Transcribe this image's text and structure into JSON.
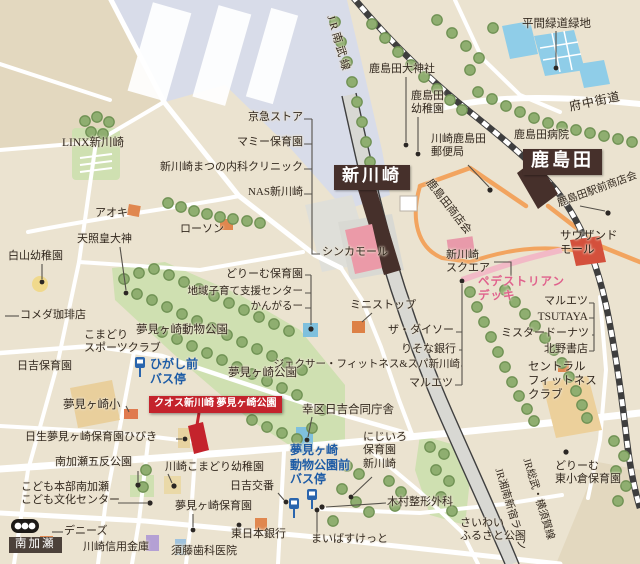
{
  "map": {
    "colors": {
      "background": "#ebe3d0",
      "park_green": "#cfe0b1",
      "tree_green": "#8fae70",
      "rail_yard": "#d8dce9",
      "water": "#8fcde8",
      "station_box": "#46302b",
      "property_red": "#c4232c",
      "deck_pink": "#f2b9c6",
      "road_orange": "#f2a45f",
      "bus_blue": "#2a65ad",
      "label_text": "#33291f"
    },
    "icons": [
      {
        "name": "bus-stop-icon",
        "meaning": "bus stop pole sign"
      },
      {
        "name": "crossing-roundel-icon",
        "meaning": "Minamikase crossing marker"
      },
      {
        "name": "property-marker-icon",
        "meaning": "advertised property location"
      }
    ],
    "stations": [
      "新川崎",
      "鹿島田"
    ],
    "property_flag": "クオス新川崎 夢見ヶ崎公園",
    "labels": [
      {
        "id": "jr-nambu-line-label",
        "t": "JR南武線",
        "x": 336,
        "y": 14,
        "rot": 74,
        "ls": 3,
        "s": 11
      },
      {
        "id": "hirama-ryokudo-ryokuchi",
        "t": "平間緑道緑地",
        "x": 522,
        "y": 17,
        "s": 11.5
      },
      {
        "id": "kashimada-daijinja",
        "t": "鹿島田大神社",
        "x": 369,
        "y": 63
      },
      {
        "id": "kashimada-yochien",
        "t": "鹿島田\n幼稚園",
        "x": 411,
        "y": 90
      },
      {
        "id": "fuchu-kaido",
        "t": "府中街道",
        "x": 568,
        "y": 100,
        "rot": -12,
        "s": 12,
        "ls": 1
      },
      {
        "id": "kashimada-byoin",
        "t": "鹿島田病院",
        "x": 514,
        "y": 129
      },
      {
        "id": "kawasaki-kashimada-yubinkyoku",
        "t": "川崎鹿島田\n郵便局",
        "x": 431,
        "y": 133
      },
      {
        "id": "shinkawasaki-station",
        "t": "新川崎",
        "x": 334,
        "y": 165,
        "s": 17,
        "cls": "box-sta"
      },
      {
        "id": "kashimada-station",
        "t": "鹿島田",
        "x": 523,
        "y": 149,
        "s": 18,
        "cls": "box-sta"
      },
      {
        "id": "kashimada-ekimae-shotenkai",
        "t": "鹿島田駅前商店会",
        "x": 556,
        "y": 199,
        "rot": -20,
        "s": 10.5
      },
      {
        "id": "kashimada-shotenkai",
        "t": "鹿島田商店会",
        "x": 433,
        "y": 177,
        "rot": 52,
        "s": 11
      },
      {
        "id": "keikyu-store",
        "t": "京急ストア",
        "x": 303,
        "y": 111,
        "al": "r"
      },
      {
        "id": "mammy-hoikuen",
        "t": "マミー保育園",
        "x": 303,
        "y": 136,
        "al": "r"
      },
      {
        "id": "shinkawasaki-matsuno-naika-clinic",
        "t": "新川崎まつの内科クリニック",
        "x": 303,
        "y": 161,
        "al": "r"
      },
      {
        "id": "nas-shinkawasaki",
        "t": "NAS新川崎",
        "x": 303,
        "y": 186,
        "al": "r"
      },
      {
        "id": "linx-shinkawasaki",
        "t": "LINX新川崎",
        "x": 62,
        "y": 136,
        "s": 11.5
      },
      {
        "id": "aoki",
        "t": "アオキ",
        "x": 95,
        "y": 207
      },
      {
        "id": "lawson",
        "t": "ローソン",
        "x": 180,
        "y": 223
      },
      {
        "id": "tensho-kotaijin",
        "t": "天照皇大神",
        "x": 77,
        "y": 233
      },
      {
        "id": "hakusan-yochien",
        "t": "白山幼稚園",
        "x": 8,
        "y": 250
      },
      {
        "id": "dream-hoikuen",
        "t": "どりーむ保育園",
        "x": 303,
        "y": 268,
        "al": "r"
      },
      {
        "id": "chiiki-kosodate-shien-center",
        "t": "地域子育て支援センター",
        "x": 303,
        "y": 286,
        "al": "r",
        "s": 10.5
      },
      {
        "id": "kangaroo",
        "t": "かんがるー",
        "x": 303,
        "y": 301,
        "al": "r",
        "s": 10.5
      },
      {
        "id": "komeda-coffee",
        "t": "コメダ珈琲店",
        "x": 20,
        "y": 309
      },
      {
        "id": "komadori-sports-club",
        "t": "こまどり\nスポーツクラブ",
        "x": 84,
        "y": 329
      },
      {
        "id": "yumemigasaki-dobutsu-koen",
        "t": "夢見ヶ崎動物公園",
        "x": 136,
        "y": 323,
        "s": 11.5
      },
      {
        "id": "hiyoshi-hoikuen",
        "t": "日吉保育園",
        "x": 17,
        "y": 360
      },
      {
        "id": "higashimae-bus-stop",
        "t": "ひがし前\nバス停",
        "x": 150,
        "y": 357,
        "s": 12,
        "cls": "c-blue"
      },
      {
        "id": "yumemigasaki-koen",
        "t": "夢見ヶ崎公園",
        "x": 228,
        "y": 366,
        "s": 11.5
      },
      {
        "id": "jexer-fitness-spa",
        "t": "ジェクサー・フィットネス&スパ新川崎",
        "x": 460,
        "y": 359,
        "al": "r",
        "s": 10.5
      },
      {
        "id": "ministop",
        "t": "ミニストップ",
        "x": 350,
        "y": 299
      },
      {
        "id": "the-daiso",
        "t": "ザ・ダイソー",
        "x": 454,
        "y": 324,
        "al": "r"
      },
      {
        "id": "risona-bank",
        "t": "りそな銀行",
        "x": 456,
        "y": 343,
        "al": "r"
      },
      {
        "id": "maruetsu-west",
        "t": "マルエツ",
        "x": 453,
        "y": 377,
        "al": "r"
      },
      {
        "id": "saiwai-ku-hiyoshi-godo-chosha",
        "t": "幸区日吉合同庁舎",
        "x": 302,
        "y": 403,
        "s": 11.5
      },
      {
        "id": "shinka-mall",
        "t": "シンカモール",
        "x": 322,
        "y": 246
      },
      {
        "id": "shinkawasaki-square",
        "t": "新川崎\nスクエア",
        "x": 446,
        "y": 249
      },
      {
        "id": "pedestrian-deck",
        "t": "ペデストリアン\nデッキ",
        "x": 478,
        "y": 275,
        "cls": "c-pink",
        "s": 11.5
      },
      {
        "id": "thousand-mall",
        "t": "サウザンド\nモール",
        "x": 560,
        "y": 229,
        "s": 11.5
      },
      {
        "id": "maruetsu-east",
        "t": "マルエツ",
        "x": 588,
        "y": 295,
        "al": "r"
      },
      {
        "id": "tsutaya",
        "t": "TSUTAYA",
        "x": 588,
        "y": 310,
        "al": "r",
        "s": 11.5
      },
      {
        "id": "mister-donut",
        "t": "ミスタードーナツ",
        "x": 589,
        "y": 327,
        "al": "r"
      },
      {
        "id": "kitano-shoten",
        "t": "北野書店",
        "x": 588,
        "y": 343,
        "al": "r"
      },
      {
        "id": "central-fitness-club",
        "t": "セントラル\nフィットネス\nクラブ",
        "x": 528,
        "y": 360,
        "s": 11.5
      },
      {
        "id": "yumemigasaki-sho",
        "t": "夢見ヶ崎小",
        "x": 63,
        "y": 398,
        "s": 11.5
      },
      {
        "id": "quos-shinkawasaki-flag",
        "t": "クオス新川崎 夢見ヶ崎公園",
        "x": 149,
        "y": 396,
        "s": 10,
        "cls": "box-flag"
      },
      {
        "id": "nissei-yumemigasaki-hoikuen-hibiki",
        "t": "日生夢見ヶ崎保育園ひびき",
        "x": 25,
        "y": 431
      },
      {
        "id": "minamikase-gotan-koen",
        "t": "南加瀬五反公園",
        "x": 55,
        "y": 456
      },
      {
        "id": "kawasaki-komadori-yochien",
        "t": "川崎こまどり幼稚園",
        "x": 165,
        "y": 461
      },
      {
        "id": "hiyoshi-koban",
        "t": "日吉交番",
        "x": 230,
        "y": 480
      },
      {
        "id": "kodomo-honbu-minamikase",
        "t": "こども本部南加瀬\nこども文化センター",
        "x": 21,
        "y": 481
      },
      {
        "id": "yumemigasaki-hoikuen",
        "t": "夢見ヶ崎保育園",
        "x": 175,
        "y": 500
      },
      {
        "id": "dennys",
        "t": "デニーズ",
        "x": 64,
        "y": 525
      },
      {
        "id": "minamikase-stop",
        "t": "南加瀬",
        "x": 9,
        "y": 537,
        "s": 11.5,
        "cls": "box-stop"
      },
      {
        "id": "kawasaki-shinyo-kinko",
        "t": "川崎信用金庫",
        "x": 83,
        "y": 541
      },
      {
        "id": "sudo-shika-iin",
        "t": "須藤歯科医院",
        "x": 171,
        "y": 545
      },
      {
        "id": "higashi-nippon-bank",
        "t": "東日本銀行",
        "x": 231,
        "y": 528
      },
      {
        "id": "yumemigasaki-zoo-mae-bus-stop",
        "t": "夢見ヶ崎\n動物公園前\nバス停",
        "x": 290,
        "y": 443,
        "s": 12,
        "cls": "c-blue"
      },
      {
        "id": "nijiiro-hoikuen-shinkawasaki",
        "t": "にじいろ\n保育園\n新川崎",
        "x": 363,
        "y": 431
      },
      {
        "id": "kimura-seikei-geka",
        "t": "木村整形外科",
        "x": 387,
        "y": 496
      },
      {
        "id": "my-basket",
        "t": "まいばすけっと",
        "x": 311,
        "y": 533
      },
      {
        "id": "saiwai-furusato-koen",
        "t": "さいわい\nふるさと公園",
        "x": 460,
        "y": 517
      },
      {
        "id": "dream-higashiogura-hoikuen",
        "t": "どりーむ\n東小倉保育園",
        "x": 555,
        "y": 460
      },
      {
        "id": "jr-shonan-shinjuku-line-label",
        "t": "JR湘南新宿ライン",
        "x": 503,
        "y": 467,
        "rot": 73,
        "s": 10.5
      },
      {
        "id": "jr-sobu-yokosuka-line-label",
        "t": "JR総武・横須賀線",
        "x": 531,
        "y": 457,
        "rot": 73,
        "s": 10.5
      }
    ]
  }
}
